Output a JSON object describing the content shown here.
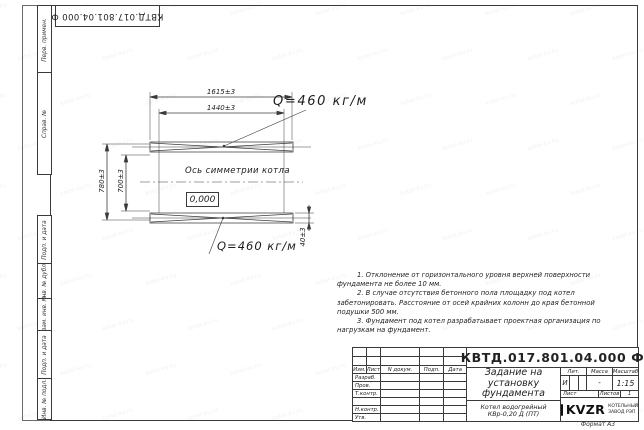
{
  "doc": {
    "top_stamp": "КВТД.017.801.04.000 Ф",
    "format_label": "Формат А3"
  },
  "sidebar": {
    "items": [
      {
        "label": "Перв. примен."
      },
      {
        "label": "Справ. №"
      },
      {
        "label": "Подп. и дата"
      },
      {
        "label": "Инв. № дубл."
      },
      {
        "label": "Взам. инв. №"
      },
      {
        "label": "Подп. и дата"
      },
      {
        "label": "Инв. № подл."
      }
    ]
  },
  "drawing": {
    "dim_1615": "1615±3",
    "dim_1440": "1440±3",
    "dim_780": "780±3",
    "dim_700": "700±3",
    "dim_40": "40±3",
    "load_top": "Q=460 кг/м",
    "load_bottom": "Q=460 кг/м",
    "axis_label": "Ось симметрии котла",
    "level_mark": "0,000"
  },
  "notes": {
    "lines": [
      "1. Отклонение от горизонтального уровня верхней поверхности",
      "фундамента не более 10 мм.",
      "2. В случае отсутствия бетонного пола площадку под котел",
      "забетонировать. Расстояние от осей крайних колонн до края бетонной",
      "подушки 500 мм.",
      "3. Фундамент под котел разрабатывает проектная организация по",
      "нагрузкам на фундамент."
    ]
  },
  "title_block": {
    "doc_number": "КВТД.017.801.04.000 Ф",
    "title_line1": "Задание на",
    "title_line2": "установку",
    "title_line3": "фундамента",
    "product_line1": "Котел водогрейный",
    "product_line2": "КВр-0,20 Д (ПТ)",
    "col_izm": "Изм.",
    "col_list": "Лист",
    "col_doc": "N докум.",
    "col_podp": "Подп.",
    "col_data": "Дата",
    "row_razrab": "Разраб.",
    "row_prov": "Пров.",
    "row_tkontr": "Т.контр.",
    "row_nkontr": "Н.контр.",
    "row_utv": "Утв.",
    "lit_label": "Лит.",
    "lit_value": "И",
    "mass_label": "Масса",
    "mass_value": "-",
    "scale_label": "Масштаб",
    "scale_value": "1:15",
    "sheet_label": "Лист",
    "sheets_label": "Листов",
    "sheets_value": "1",
    "logo_text": "KVZR",
    "company_line1": "КОТЕЛЬНЫЙ",
    "company_line2": "ЗАВОД РЭП"
  },
  "watermark": {
    "text": "kotel-kv.ru"
  }
}
